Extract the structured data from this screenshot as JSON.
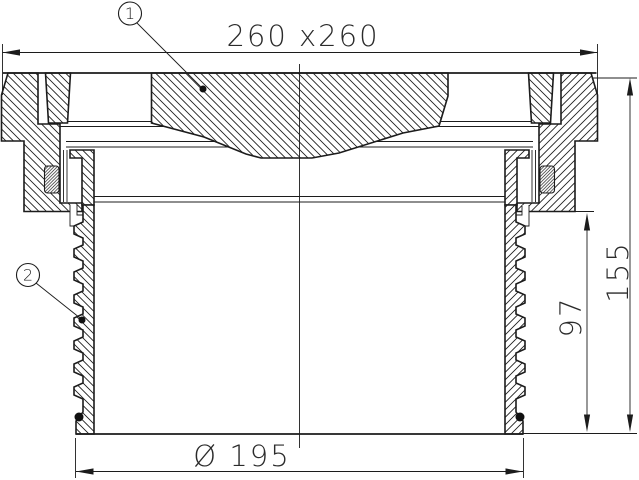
{
  "drawing": {
    "dimensions": {
      "width": "260 x260",
      "total_height": "155",
      "spigot_height": "97",
      "diameter": "Ø 195"
    },
    "callouts": [
      {
        "label": "1"
      },
      {
        "label": "2"
      }
    ],
    "colors": {
      "line": "#1c1c1c",
      "background": "#ffffff"
    }
  }
}
